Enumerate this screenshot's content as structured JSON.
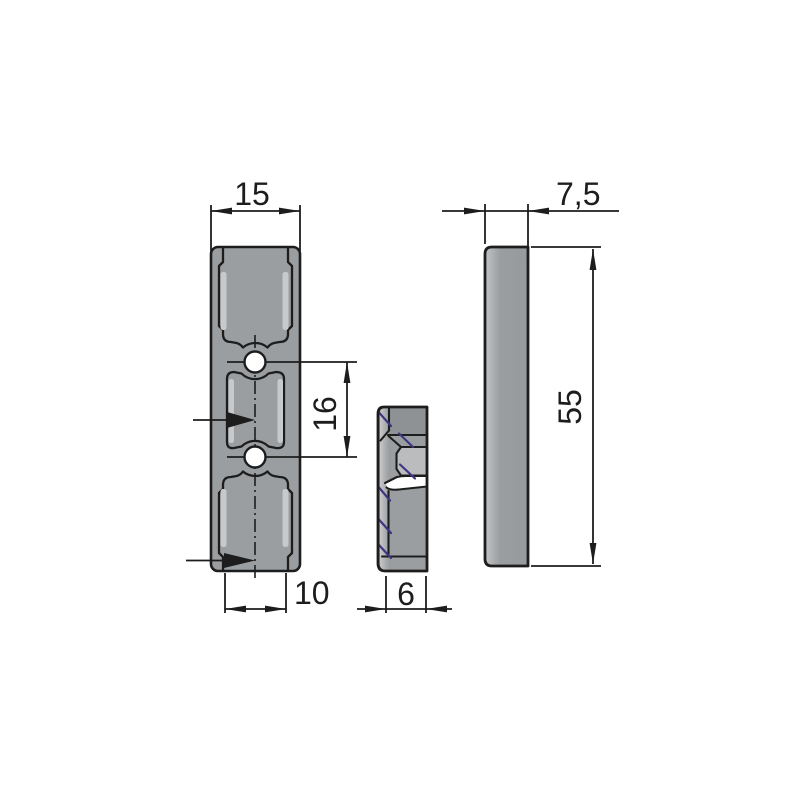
{
  "dims": {
    "top_width": "15",
    "hole_spacing": "16",
    "bottom_width": "10",
    "section_thickness": "6",
    "side_thickness": "7,5",
    "height": "55"
  },
  "colors": {
    "background": "#ffffff",
    "line": "#1d1d1d",
    "part-fill": "#9b9ea1",
    "part-light": "#c7c9cb",
    "section-dark": "#8f9295",
    "section-lighter": "#babcbe",
    "hatch": "#3f3580"
  }
}
